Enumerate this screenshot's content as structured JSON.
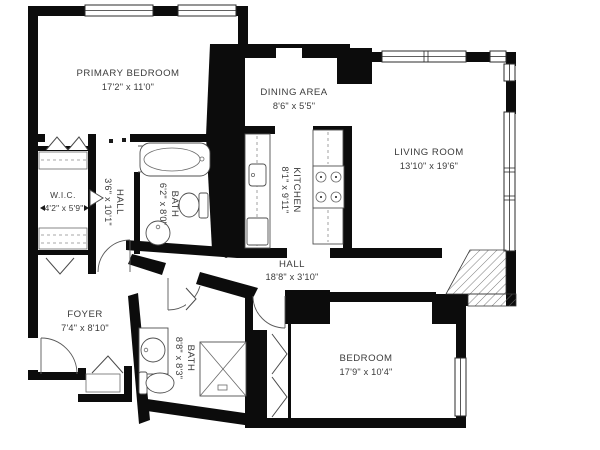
{
  "floorplan": {
    "background_color": "#ffffff",
    "wall_color": "#0c0c0c",
    "line_color": "#4f4f4f",
    "rooms": {
      "primary_bedroom": {
        "name": "PRIMARY BEDROOM",
        "dims": "17'2\" x 11'0\""
      },
      "dining_area": {
        "name": "DINING AREA",
        "dims": "8'6\" x 5'5\""
      },
      "living_room": {
        "name": "LIVING ROOM",
        "dims": "13'10\" x 19'6\""
      },
      "kitchen": {
        "name": "KITCHEN",
        "dims": "8'1\" x 9'11\""
      },
      "wic": {
        "name": "W.I.C.",
        "dims": "4'2\" x 5'9\""
      },
      "hall_upper": {
        "name": "HALL",
        "dims": "3'6\" x 10'1\""
      },
      "bath_primary": {
        "name": "BATH",
        "dims": "6'2\" x 8'0\""
      },
      "hall_main": {
        "name": "HALL",
        "dims": "18'8\" x 3'10\""
      },
      "foyer": {
        "name": "FOYER",
        "dims": "7'4\" x 8'10\""
      },
      "bath_lower": {
        "name": "BATH",
        "dims": "8'8\" x 8'3\""
      },
      "bedroom": {
        "name": "BEDROOM",
        "dims": "17'9\" x 10'4\""
      }
    },
    "fixtures": [
      "bathtub",
      "toilet",
      "pedestal-sink",
      "vanity-sink",
      "shower-stall",
      "kitchen-sink",
      "stove-cooktop",
      "refrigerator",
      "closet-shelving",
      "bifold-closet-doors",
      "door-swing",
      "window",
      "hatched-column"
    ]
  }
}
